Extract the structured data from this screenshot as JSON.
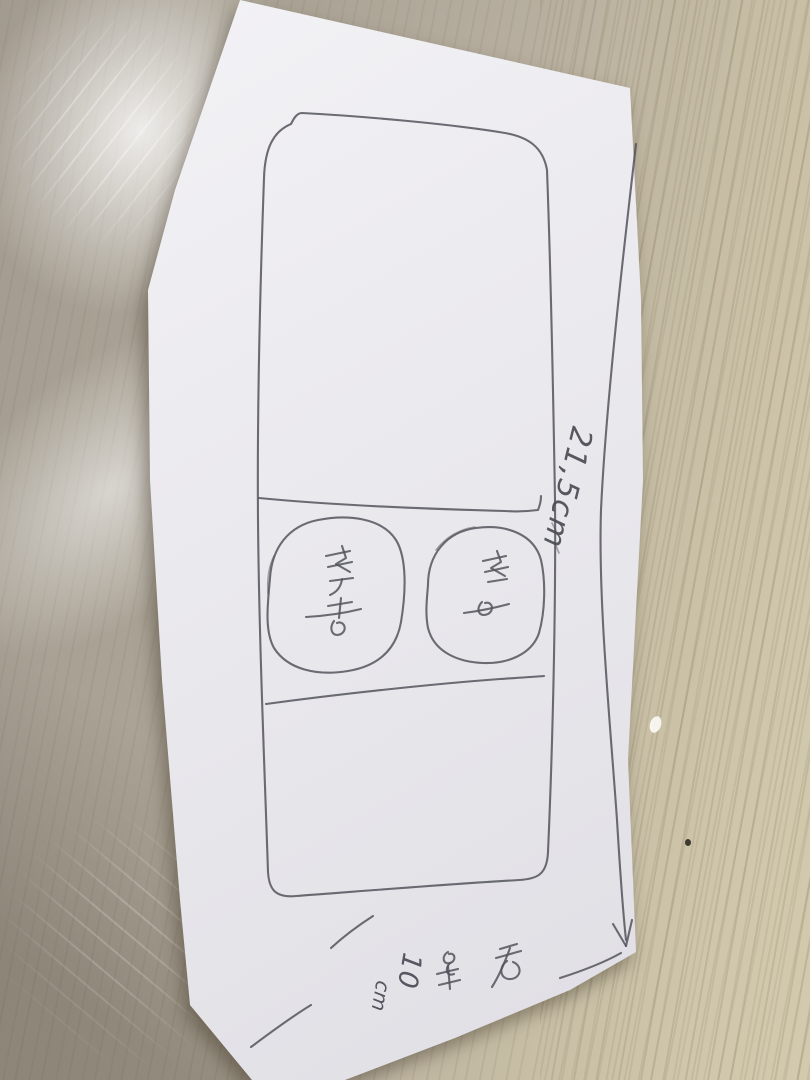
{
  "scene": {
    "description": "Photo of a hand-drawn pencil sketch on a white sheet of paper lying on a beige wooden floor. The sketch shows a large rounded rectangle with a middle band containing two hand-drawn circles, with handwritten dimension annotations."
  },
  "annotations": {
    "side_dimension_label": "21,5cm",
    "bottom_dimension_word": "전체",
    "bottom_dimension_value": "10",
    "bottom_dimension_unit": "cm",
    "left_circle_label": "신랑",
    "right_circle_label": "신부"
  },
  "colors": {
    "pencil": "#54545d",
    "paper": "#ebeaee",
    "floor_left": "#a29b90",
    "floor_right": "#d3caae"
  }
}
